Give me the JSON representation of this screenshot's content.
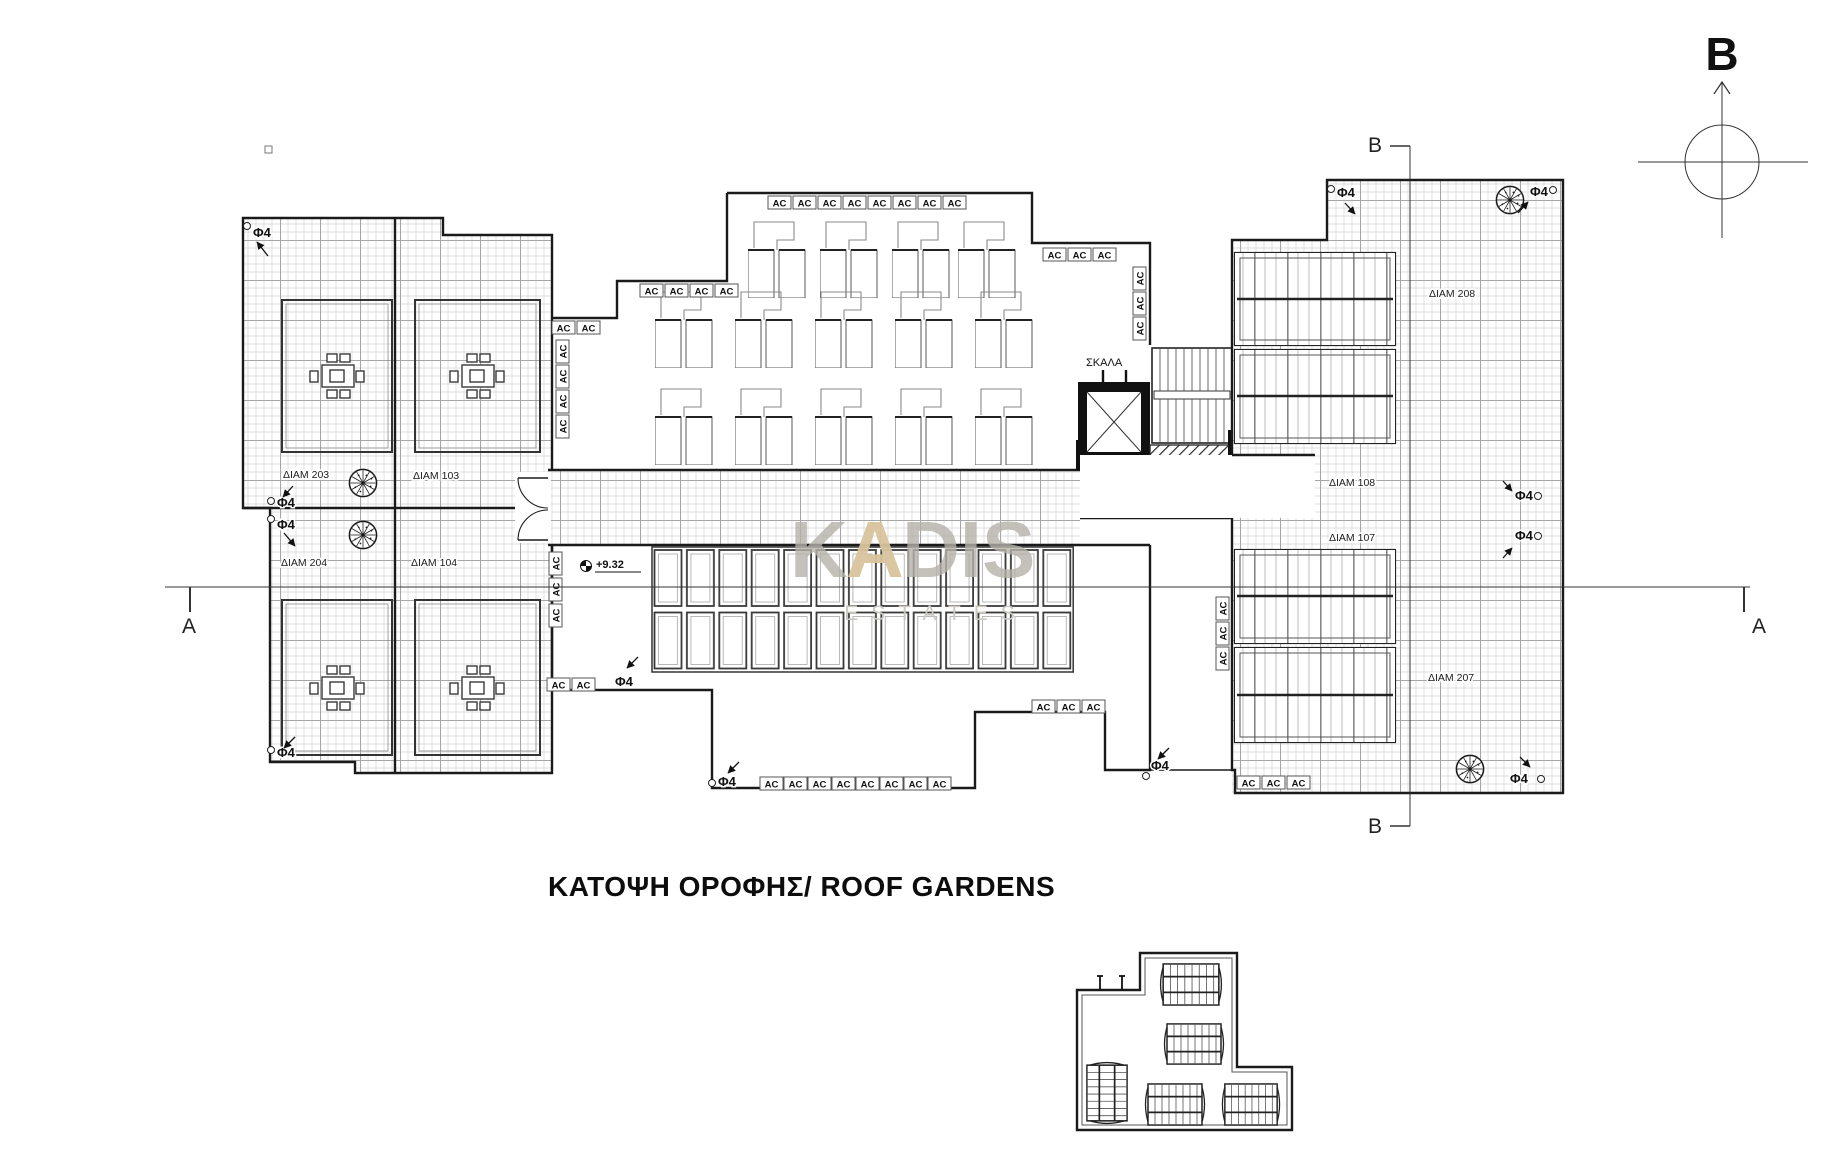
{
  "drawing": {
    "title": "ΚΑΤΟΨΗ ΟΡΟΦΗΣ/ ROOF GARDENS",
    "north_label": "B",
    "section_a": "A",
    "section_b": "B",
    "stairs_label": "ΣΚΑΛΑ",
    "elevation_marker": "+9.32",
    "ac_label": "AC",
    "drain_label": "Φ4",
    "apartments": {
      "a203": "ΔΙΑΜ 203",
      "a103": "ΔΙΑΜ 103",
      "a204": "ΔΙΑΜ 204",
      "a104": "ΔΙΑΜ 104",
      "a108": "ΔΙΑΜ 108",
      "a107": "ΔΙΑΜ 107",
      "a208": "ΔΙΑΜ 208",
      "a207": "ΔΙΑΜ 207"
    },
    "watermark": {
      "part1": "K",
      "accent": "A",
      "part2": "DIS",
      "subtitle": "ESTATES"
    },
    "colors": {
      "line": "#1a1a1a",
      "hatch": "#c9c9c9",
      "watermark_gray": "#b6b1aa",
      "watermark_gold": "#d9c49c"
    }
  }
}
